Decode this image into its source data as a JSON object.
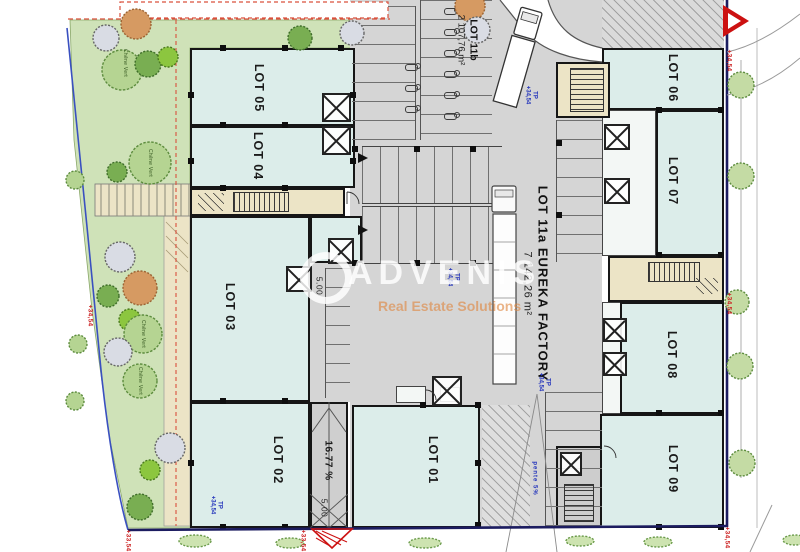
{
  "watermark": {
    "brand": "ADVENIS",
    "tagline": "Real Estate Solutions"
  },
  "lots": {
    "lot01": "LOT 01",
    "lot02": "LOT 02",
    "lot03": "LOT 03",
    "lot04": "LOT 04",
    "lot05": "LOT 05",
    "lot06": "LOT 06",
    "lot07": "LOT 07",
    "lot08": "LOT 08",
    "lot09": "LOT 09"
  },
  "lot11a": {
    "name": "LOT 11a EUREKA FACTORY",
    "area": "7 142,26 m²"
  },
  "lot11b": {
    "name": "LOT 11b",
    "area": "2 107,76 m²"
  },
  "ramp": {
    "slope": "16.77 %",
    "dim1": "5.00",
    "dim2": "5.00"
  },
  "ann": {
    "tp": "TP",
    "level": "+34,54",
    "level_low": "+33,54",
    "pente": "pente 5%"
  },
  "trees": {
    "species": "Chêne Vert"
  },
  "colors": {
    "room_fill": "#dcedea",
    "circulation_fill": "#d5d5d5",
    "landscape_fill": "#cfe2b8",
    "path_fill": "#ece4c6",
    "boundary_navy": "#1c1c60",
    "site_line_blue": "#3a50c0",
    "marker_red": "#cc2222",
    "annotation_blue": "#2233bb",
    "tree_green": "#79ae52",
    "watermark_orange": "#df863f"
  }
}
